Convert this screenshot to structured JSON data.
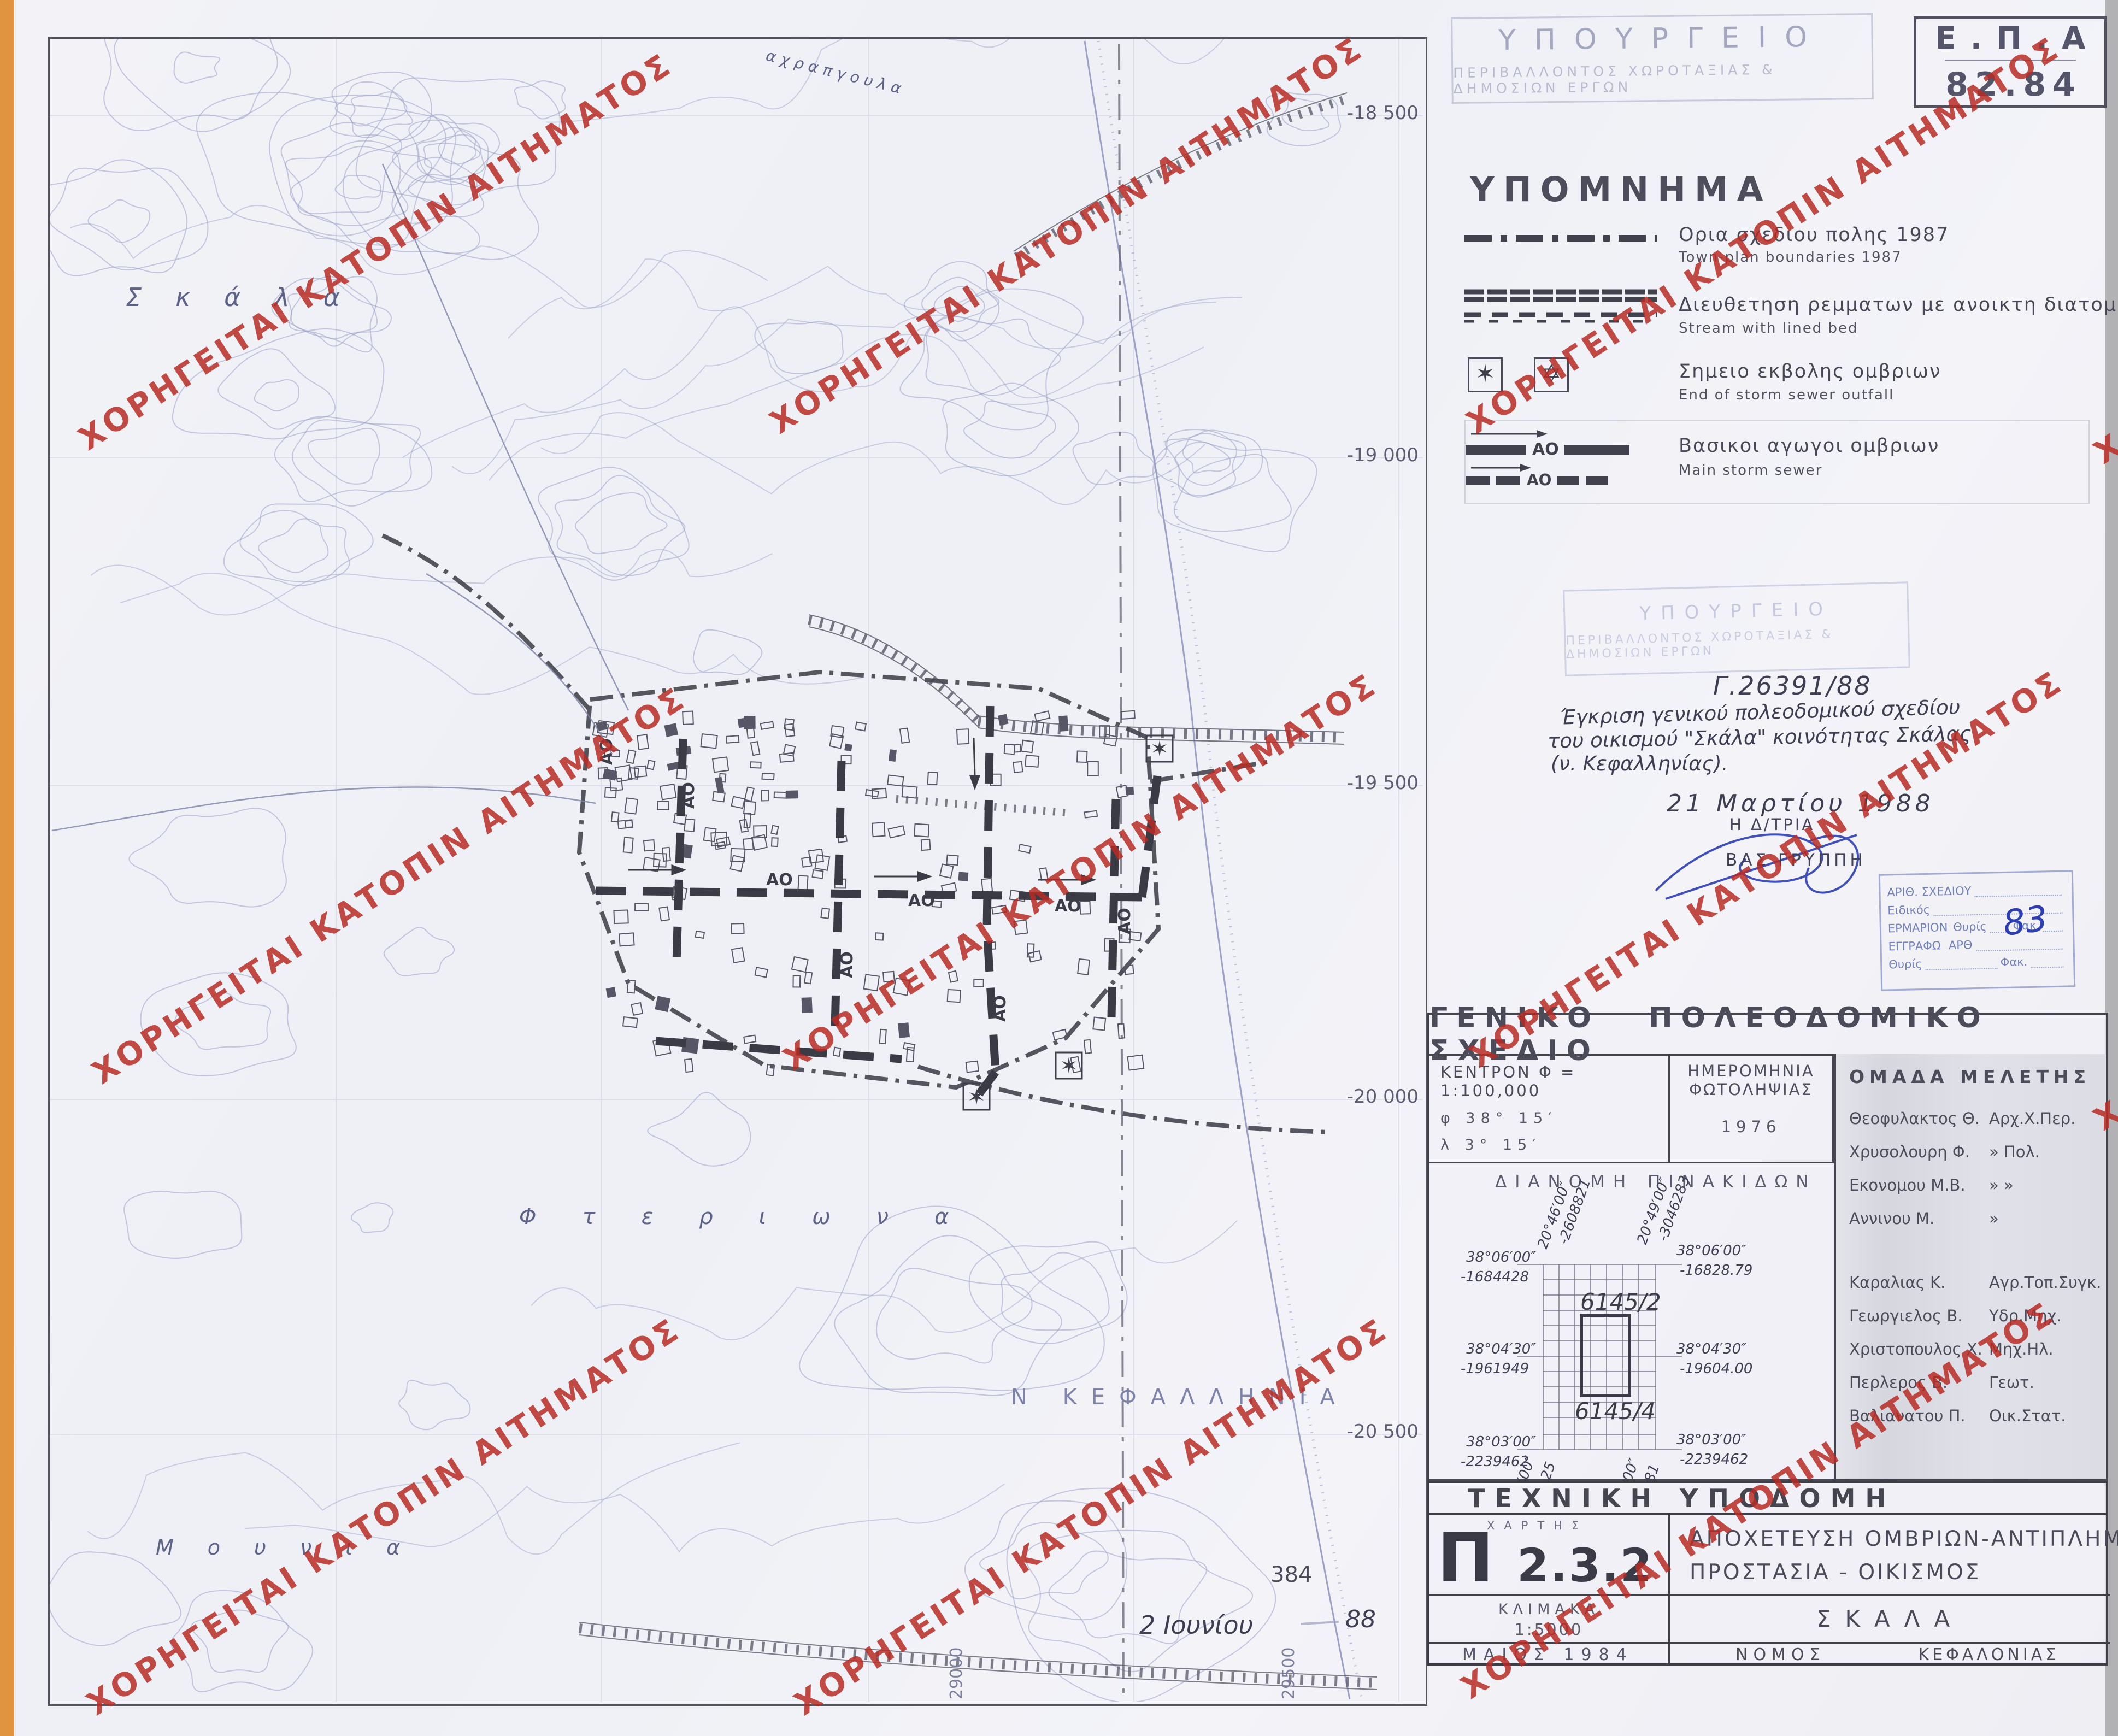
{
  "watermark": {
    "text": "ΧΟΡΗΓΕΙΤΑΙ ΚΑΤΟΠΙΝ ΑΙΤΗΜΑΤΟΣ",
    "color": "#b92b25"
  },
  "epa": {
    "line1": "Ε.Π.Α",
    "line2": "82.84"
  },
  "ministry_stamp": {
    "line1": "ΥΠΟΥΡΓΕΙΟ",
    "line2": "ΠΕΡΙΒΑΛΛΟΝΤΟΣ  ΧΩΡΟΤΑΞΙΑΣ  &  ΔΗΜΟΣΙΩΝ  ΕΡΓΩΝ"
  },
  "legend": {
    "title": "ΥΠΟΜΝΗΜΑ",
    "ao": "ΑΟ",
    "items": [
      {
        "gr": "Ορια σχεδιου πολης 1987",
        "en": "Town-plan boundaries 1987"
      },
      {
        "gr": "Διευθετηση ρεμματων με ανοικτη διατομη",
        "en": "Stream with lined bed"
      },
      {
        "gr": "Σημειο εκβολης ομβριων",
        "en": "End of storm sewer outfall"
      },
      {
        "gr": "Βασικοι αγωγοι ομβριων",
        "en": "Main storm sewer"
      }
    ],
    "star_filled": "✶",
    "star_outline": "✡"
  },
  "approval": {
    "ref": "Γ.26391/88",
    "line1": "Έγκριση γενικού πολεοδομικού σχεδίου",
    "line2": "του οικισμού \"Σκάλα\" κοινότητας Σκάλας",
    "line3": "(ν. Κεφαλληνίας).",
    "date": "21 Μαρτίου 1988",
    "role": "Η Δ/ΤΡΙΑ",
    "signer": "ΒΑΣ ΓΡΥΠΠΗ"
  },
  "filing_stamp": {
    "l1": "ΑΡΙΘ. ΣΧΕΔΙΟΥ",
    "l2": "Ειδικός",
    "l3a": "ΕΡΜΑΡΙΟΝ",
    "thyris": "Θυρίς",
    "fak": "Φακ.",
    "fak_value": "83",
    "l4a": "ΕΓΓΡΑΦΩ",
    "arth": "ΑΡΘ",
    "l5a": "Θυρίς",
    "l5b": "Φακ."
  },
  "title_block": {
    "title": "ΓΕΝΙΚΟ ΠΟΛΕΟΔΟΜΙΚΟ ΣΧΕΔΙΟ",
    "kentron": "ΚΕΝΤΡΟΝ  Φ =  1:100,000",
    "phi": "φ   38° 15′",
    "lambda": "λ   3° 15′",
    "photo_label1": "ΗΜΕΡΟΜΗΝΙΑ",
    "photo_label2": "ΦΩΤΟΛΗΨΙΑΣ",
    "photo_value": "1976",
    "team_title": "ΟΜΑΔΑ  ΜΕΛΕΤΗΣ",
    "team": [
      {
        "name": "Θεοφυλακτος Θ.",
        "role": "Αρχ.Χ.Περ."
      },
      {
        "name": "Χρυσολουρη Φ.",
        "role": "»  Πολ."
      },
      {
        "name": "Εκονομου Μ.Β.",
        "role": "»  »"
      },
      {
        "name": "Αννινου Μ.",
        "role": "»"
      },
      {
        "name": "Καραλιας Κ.",
        "role": "Αγρ.Τοπ.Συγκ."
      },
      {
        "name": "Γεωργιελος Β.",
        "role": "Υδρ.Μηχ."
      },
      {
        "name": "Χριστοπουλος Χ.",
        "role": "Μηχ.Ηλ."
      },
      {
        "name": "Περλερος Β.",
        "role": "Γεωτ."
      },
      {
        "name": "Βαλιανατου Π.",
        "role": "Οικ.Στατ."
      }
    ],
    "dianomi": "ΔΙΑΝΟΜΗ  ΠΙΝΑΚΙΔΩΝ",
    "coords": {
      "tl_deg": "38°06′00″",
      "tl_val": "-1684428",
      "tr_deg": "38°06′00″",
      "tr_val": "-16828.79",
      "ml_deg": "38°04′30″",
      "ml_val": "-1961949",
      "mr_deg": "38°04′30″",
      "mr_val": "-19604.00",
      "bl_deg": "38°03′00″",
      "bl_val": "-2239462",
      "br_deg": "38°03′00″",
      "br_val": "-2239462",
      "vtl_deg": "20°46′00″",
      "vtl_val": "-2608821",
      "vtr_deg": "20°49′00″",
      "vtr_val": "-3046283",
      "vbl_deg": "20°46′00″",
      "vbl_val": "-2609125",
      "vbr_deg": "20°49′00″",
      "vbr_val": "-3048081",
      "sheet_top": "6145/2",
      "sheet_bottom": "6145/4"
    }
  },
  "tech_block": {
    "title": "ΤΕΧΝΙΚΗ ΥΠΟΔΟΜΗ",
    "map_label": "ΧΑΡΤΗΣ",
    "map_glyph": "Π",
    "map_number": "2.3.2",
    "subject_line1": "ΑΠΟΧΕΤΕΥΣΗ ΟΜΒΡΙΩΝ-ΑΝΤΙΠΛΗΜΜΥΡΙΚΗ",
    "subject_line2": "ΠΡΟΣΤΑΣΙΑ - ΟΙΚΙΣΜΟΣ",
    "scale_label": "ΚΛΙΜΑΚΑ",
    "scale_value": "1:5000",
    "place": "ΣΚΑΛΑ",
    "date": "ΜΑΙΟΣ 1984",
    "nomos_label": "ΝΟΜΟΣ",
    "nomos_value": "ΚΕΦΑΛΟΝΙΑΣ"
  },
  "map": {
    "grid_right": [
      "-18 500",
      "-19 000",
      "-19 500",
      "-20 000",
      "-20 500"
    ],
    "grid_bottom": [
      "29000",
      "29500"
    ],
    "ao": "ΑΟ",
    "names": {
      "skala": "Σκάλα",
      "fteriona": "Φτεριωνα",
      "mounia": "Μουνια",
      "kefallinia": "Ν  ΚΕΦΑΛΛΗΝΙΑ",
      "path": "αχραπγουλα"
    },
    "sheet_note": "384",
    "hand_date": "2 Ιουνίου",
    "hand_year": "88"
  }
}
